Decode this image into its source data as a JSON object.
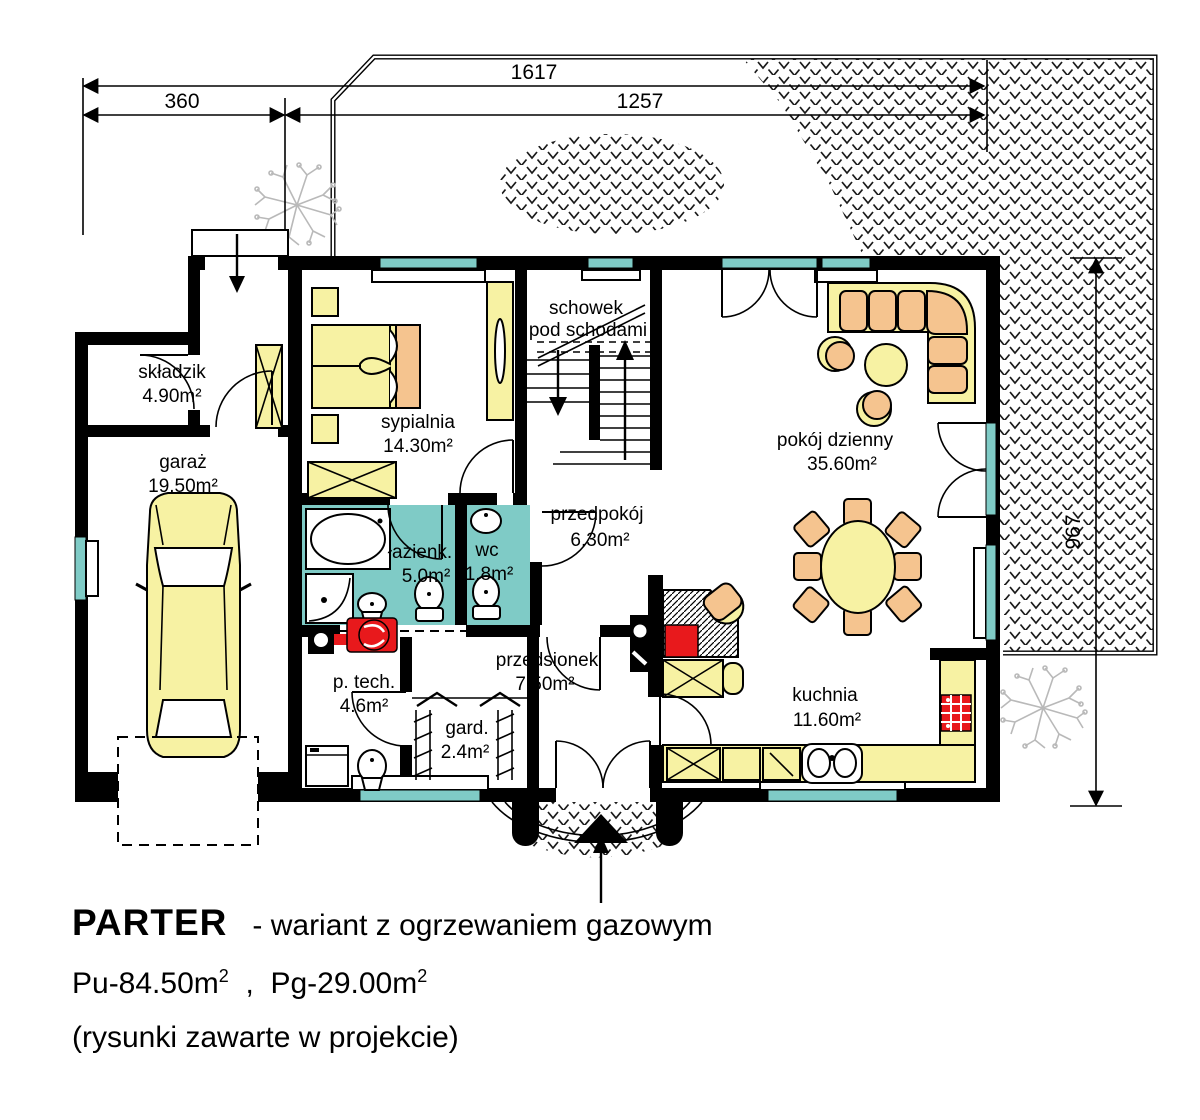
{
  "dimensions": {
    "top_total": "1617",
    "top_left": "360",
    "top_right": "1257",
    "right_height": "967"
  },
  "rooms": {
    "skladzik": {
      "name": "składzik",
      "area": "4.90m²"
    },
    "garaz": {
      "name": "garaż",
      "area": "19.50m²"
    },
    "sypialnia": {
      "name": "sypialnia",
      "area": "14.30m²"
    },
    "schowek": {
      "line1": "schowek",
      "line2": "pod schodami"
    },
    "lazienka": {
      "name": "łazienk.",
      "area": "5.0m²"
    },
    "wc": {
      "name": "wc",
      "area": "1.8m²"
    },
    "przedpokoj": {
      "name": "przedpokój",
      "area": "6.30m²"
    },
    "pokoj_dzienny": {
      "name": "pokój dzienny",
      "area": "35.60m²"
    },
    "p_tech": {
      "name": "p. tech.",
      "area": "4.6m²"
    },
    "gard": {
      "name": "gard.",
      "area": "2.4m²"
    },
    "przedsionek": {
      "name": "przedsionek",
      "area": "7.50m²"
    },
    "kuchnia": {
      "name": "kuchnia",
      "area": "11.60m²"
    }
  },
  "footer": {
    "title_bold": "PARTER",
    "title_rest": "- wariant z ogrzewaniem gazowym",
    "area_usable_label": "Pu-84.50m",
    "area_usable_sup": "2",
    "separator": ",",
    "area_garage_label": "Pg-29.00m",
    "area_garage_sup": "2",
    "note": "(rysunki zawarte w projekcie)"
  },
  "colors": {
    "wall_black": "#000000",
    "furniture_yellow": "#F7F2A3",
    "accent_orange": "#F5C48F",
    "window_teal": "#7FCBC6",
    "fixture_red": "#E8191C",
    "tree_gray": "#B9B9B9"
  }
}
